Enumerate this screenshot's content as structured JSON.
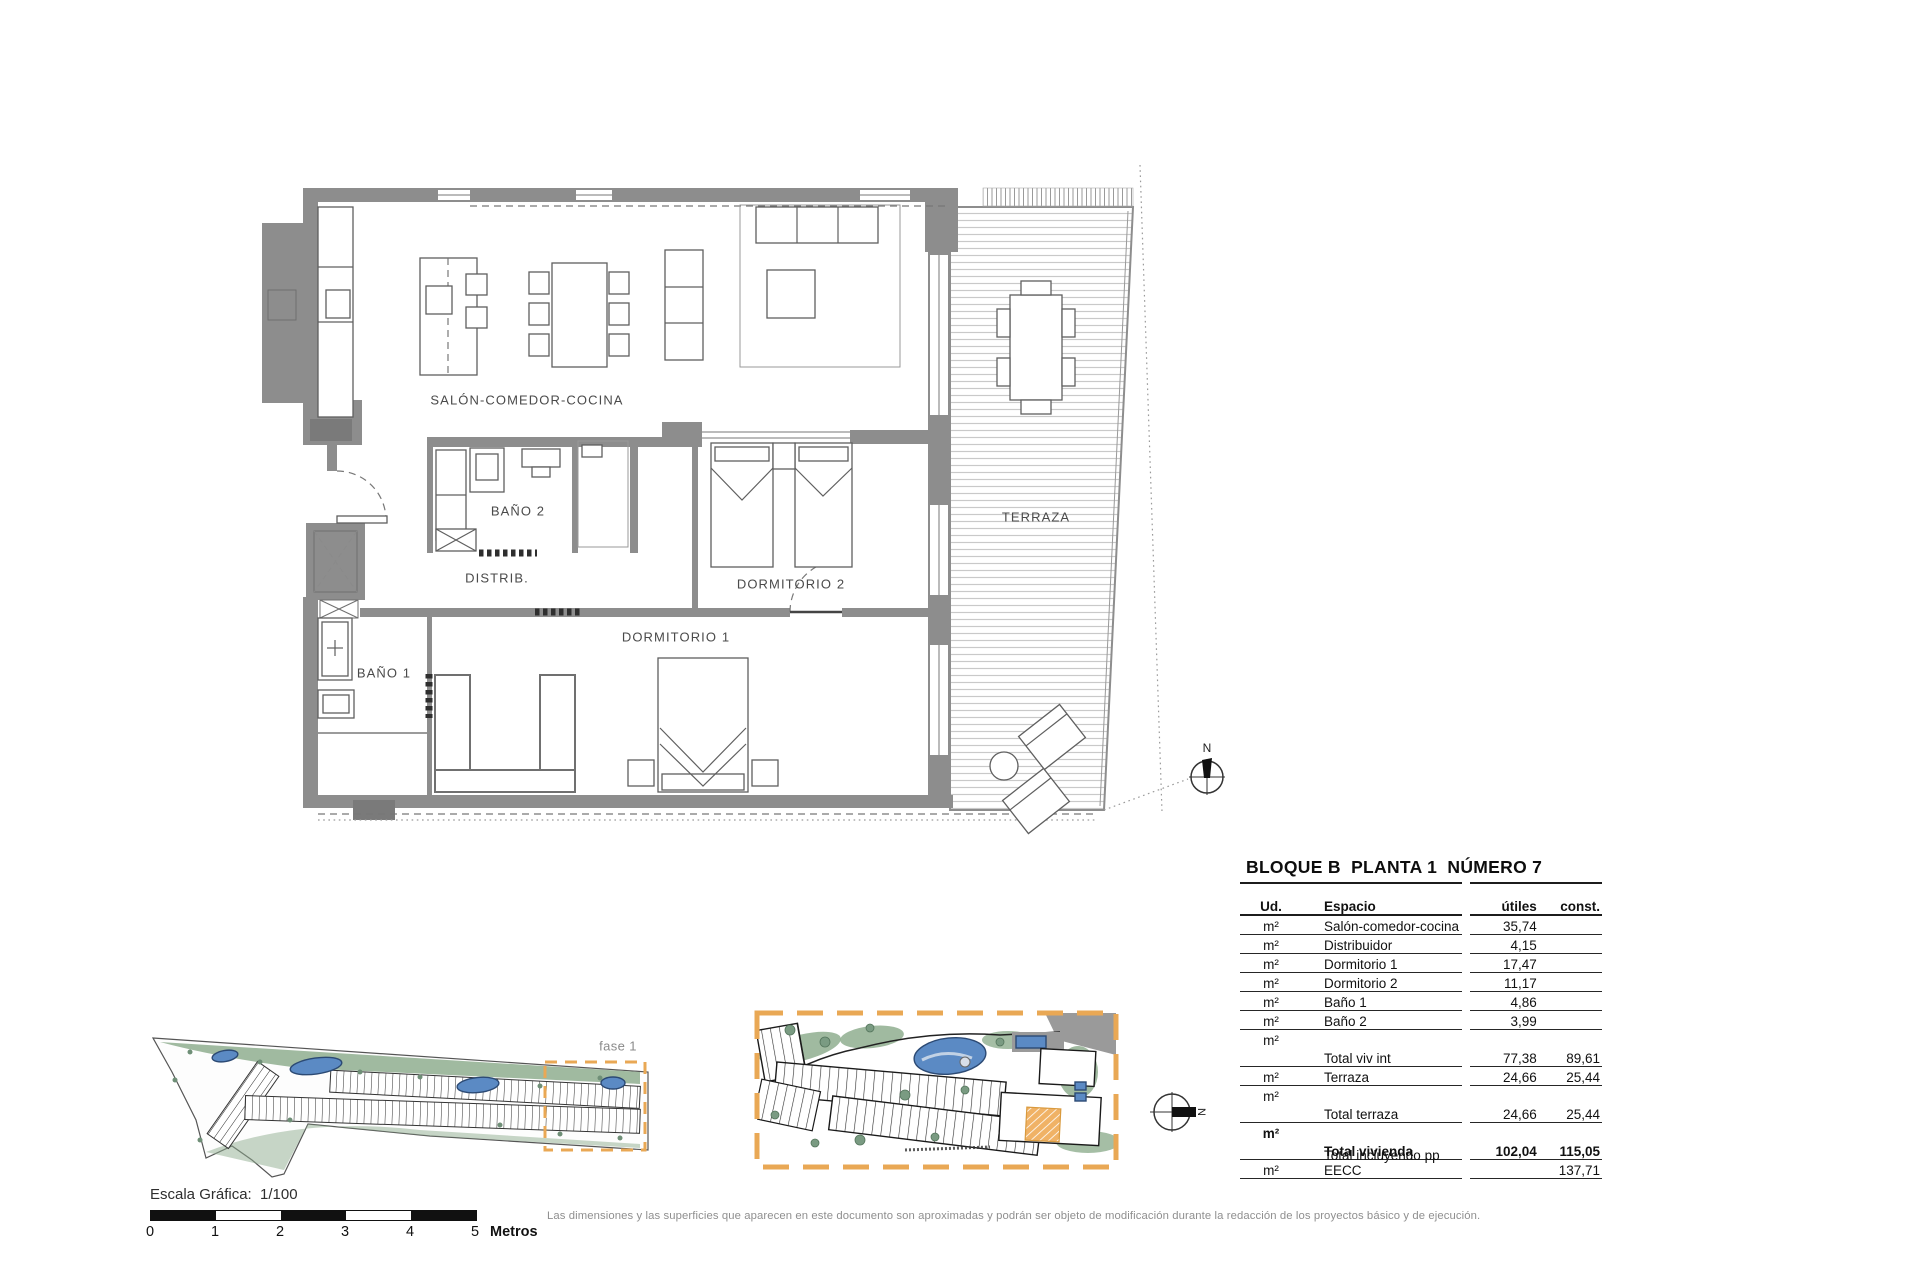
{
  "floor_plan": {
    "rooms": [
      {
        "label": "SALÓN-COMEDOR-COCINA"
      },
      {
        "label": "BAÑO 2"
      },
      {
        "label": "DISTRIB."
      },
      {
        "label": "DORMITORIO 2"
      },
      {
        "label": "DORMITORIO 1"
      },
      {
        "label": "BAÑO 1"
      },
      {
        "label": "TERRAZA"
      }
    ],
    "compass": {
      "north": "N"
    }
  },
  "site_plans": {
    "phase_label": "fase 1",
    "detail_compass_north": "N"
  },
  "info_table": {
    "title": "BLOQUE B  PLANTA 1  NÚMERO 7",
    "header": {
      "unit": "Ud.",
      "space": "Espacio",
      "useful": "útiles",
      "built": "const."
    },
    "rows": [
      {
        "unit": "m²",
        "space": "Salón-comedor-cocina",
        "useful": "35,74",
        "built": ""
      },
      {
        "unit": "m²",
        "space": "Distribuidor",
        "useful": "4,15",
        "built": ""
      },
      {
        "unit": "m²",
        "space": "Dormitorio 1",
        "useful": "17,47",
        "built": ""
      },
      {
        "unit": "m²",
        "space": "Dormitorio 2",
        "useful": "11,17",
        "built": ""
      },
      {
        "unit": "m²",
        "space": "Baño 1",
        "useful": "4,86",
        "built": ""
      },
      {
        "unit": "m²",
        "space": "Baño 2",
        "useful": "3,99",
        "built": ""
      },
      {
        "unit": "m²",
        "space": "Total viv int",
        "useful": "77,38",
        "built": "89,61",
        "unit_above": true
      },
      {
        "unit": "m²",
        "space": "Terraza",
        "useful": "24,66",
        "built": "25,44"
      },
      {
        "unit": "m²",
        "space": "Total terraza",
        "useful": "24,66",
        "built": "25,44",
        "unit_above": true
      },
      {
        "unit": "m²",
        "space": "Total vivienda",
        "useful": "102,04",
        "built": "115,05",
        "unit_above": true,
        "emphasis": true
      },
      {
        "unit": "m²",
        "space": "Total incluyendo pp EECC",
        "useful": "",
        "built": "137,71"
      }
    ]
  },
  "scale_bar": {
    "label": "Escala Gráfica:  1/100",
    "ticks": [
      "0",
      "1",
      "2",
      "3",
      "4",
      "5"
    ],
    "unit": "Metros"
  },
  "disclaimer": "Las dimensiones y las superficies que aparecen en este documento son aproximadas y podrán ser objeto de modificación durante la redacción de los proyectos básico y de ejecución.",
  "colors": {
    "accent_orange": "#E9A855",
    "pool_blue": "#5B8AC4",
    "landscape_green": "#8FAE8F",
    "wall_gray": "#8D8D8D"
  }
}
